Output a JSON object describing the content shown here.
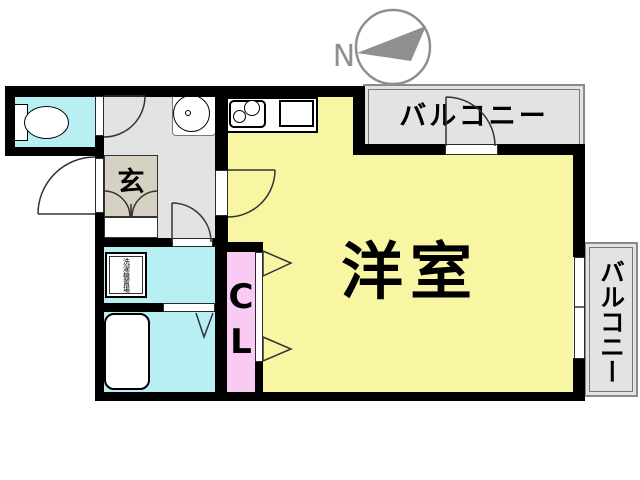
{
  "compass": {
    "label": "N"
  },
  "labels": {
    "main_room": "洋室",
    "entrance": "玄",
    "closet_line1": "C",
    "closet_line2": "L",
    "balcony_top": "バルコニー",
    "balcony_right": "バルコニー",
    "laundry": "洗濯機置場"
  },
  "colors": {
    "room_yellow": "#F8F5A3",
    "water_cyan": "#B8EFF2",
    "closet_pink": "#F9CAF2",
    "entrance_beige": "#D7D1C3",
    "floor_gray": "#E3E3E3",
    "wall_black": "#000000",
    "compass_gray": "#8F8F8F"
  }
}
